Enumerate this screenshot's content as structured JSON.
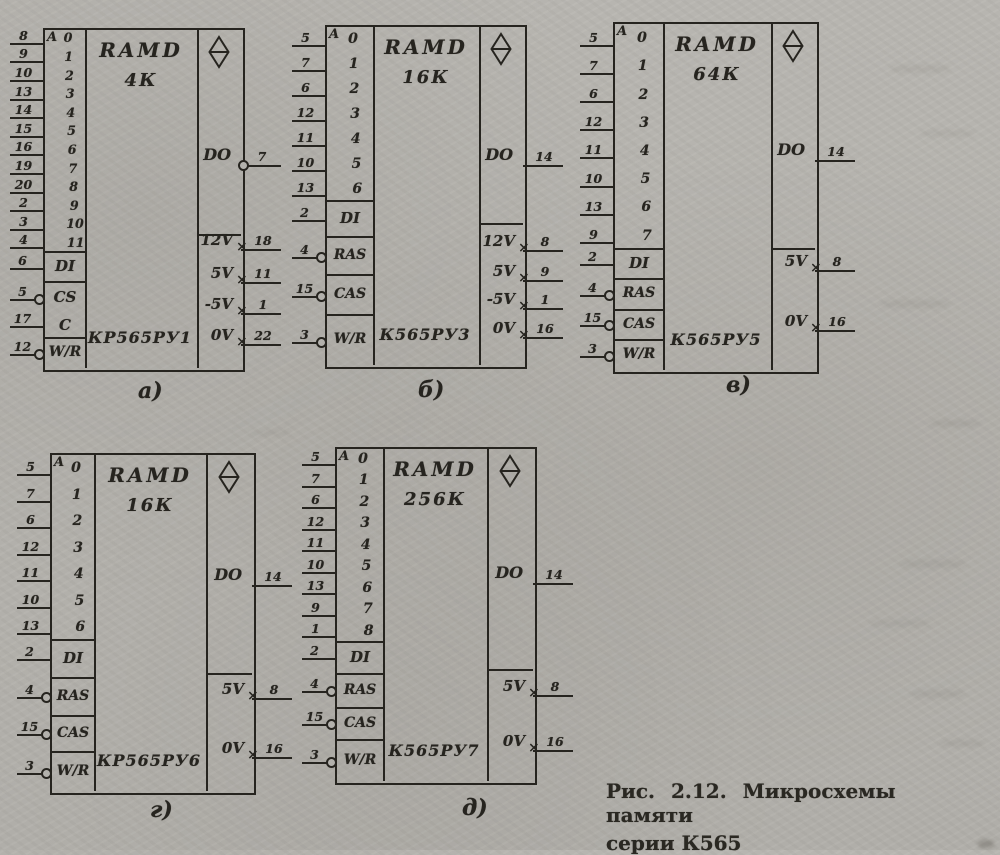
{
  "colors": {
    "ink": "#26241f",
    "paper": "#b3b1ac"
  },
  "icons": {
    "output_indicator": "tristate-diamond-icon",
    "inversion_marker": "inversion-circle-icon",
    "power_pin_marker": "×"
  },
  "figure": {
    "caption_line1": "Рис. 2.12. Микросхемы памяти",
    "caption_line2": "серии К565",
    "chips": [
      {
        "id": "a",
        "label": "а)",
        "title": "RAMD",
        "capacity": "4К",
        "name": "КР565РУ1",
        "addr_header": "A",
        "addr": [
          {
            "idx": "0",
            "pin": "8"
          },
          {
            "idx": "1",
            "pin": "9"
          },
          {
            "idx": "2",
            "pin": "10"
          },
          {
            "idx": "3",
            "pin": "13"
          },
          {
            "idx": "4",
            "pin": "14"
          },
          {
            "idx": "5",
            "pin": "15"
          },
          {
            "idx": "6",
            "pin": "16"
          },
          {
            "idx": "7",
            "pin": "19"
          },
          {
            "idx": "8",
            "pin": "20"
          },
          {
            "idx": "9",
            "pin": "2"
          },
          {
            "idx": "10",
            "pin": "3"
          },
          {
            "idx": "11",
            "pin": "4"
          }
        ],
        "controls": [
          {
            "label": "DI",
            "pin": "6",
            "inv": false
          },
          {
            "label": "CS",
            "pin": "5",
            "inv": true
          },
          {
            "label": "C",
            "pin": "17",
            "inv": false
          },
          {
            "label": "W/R",
            "pin": "12",
            "inv": true
          }
        ],
        "out": {
          "label": "DO",
          "pin": "7",
          "inv": true
        },
        "power": [
          {
            "label": "12V",
            "pin": "18"
          },
          {
            "label": "5V",
            "pin": "11"
          },
          {
            "label": "-5V",
            "pin": "1"
          },
          {
            "label": "0V",
            "pin": "22"
          }
        ]
      },
      {
        "id": "b",
        "label": "б)",
        "title": "RAMD",
        "capacity": "16К",
        "name": "К565РУ3",
        "addr_header": "A",
        "addr": [
          {
            "idx": "0",
            "pin": "5"
          },
          {
            "idx": "1",
            "pin": "7"
          },
          {
            "idx": "2",
            "pin": "6"
          },
          {
            "idx": "3",
            "pin": "12"
          },
          {
            "idx": "4",
            "pin": "11"
          },
          {
            "idx": "5",
            "pin": "10"
          },
          {
            "idx": "6",
            "pin": "13"
          }
        ],
        "controls": [
          {
            "label": "DI",
            "pin": "2",
            "inv": false
          },
          {
            "label": "RAS",
            "pin": "4",
            "inv": true
          },
          {
            "label": "CAS",
            "pin": "15",
            "inv": true
          },
          {
            "label": "W/R",
            "pin": "3",
            "inv": true
          }
        ],
        "out": {
          "label": "DO",
          "pin": "14",
          "inv": false
        },
        "power": [
          {
            "label": "12V",
            "pin": "8"
          },
          {
            "label": "5V",
            "pin": "9"
          },
          {
            "label": "-5V",
            "pin": "1"
          },
          {
            "label": "0V",
            "pin": "16"
          }
        ]
      },
      {
        "id": "c",
        "label": "в)",
        "title": "RAMD",
        "capacity": "64К",
        "name": "К565РУ5",
        "addr_header": "A",
        "addr": [
          {
            "idx": "0",
            "pin": "5"
          },
          {
            "idx": "1",
            "pin": "7"
          },
          {
            "idx": "2",
            "pin": "6"
          },
          {
            "idx": "3",
            "pin": "12"
          },
          {
            "idx": "4",
            "pin": "11"
          },
          {
            "idx": "5",
            "pin": "10"
          },
          {
            "idx": "6",
            "pin": "13"
          },
          {
            "idx": "7",
            "pin": "9"
          }
        ],
        "controls": [
          {
            "label": "DI",
            "pin": "2",
            "inv": false
          },
          {
            "label": "RAS",
            "pin": "4",
            "inv": true
          },
          {
            "label": "CAS",
            "pin": "15",
            "inv": true
          },
          {
            "label": "W/R",
            "pin": "3",
            "inv": true
          }
        ],
        "out": {
          "label": "DO",
          "pin": "14",
          "inv": false
        },
        "power": [
          {
            "label": "5V",
            "pin": "8"
          },
          {
            "label": "0V",
            "pin": "16"
          }
        ]
      },
      {
        "id": "d",
        "label": "г)",
        "title": "RAMD",
        "capacity": "16К",
        "name": "КР565РУ6",
        "addr_header": "A",
        "addr": [
          {
            "idx": "0",
            "pin": "5"
          },
          {
            "idx": "1",
            "pin": "7"
          },
          {
            "idx": "2",
            "pin": "6"
          },
          {
            "idx": "3",
            "pin": "12"
          },
          {
            "idx": "4",
            "pin": "11"
          },
          {
            "idx": "5",
            "pin": "10"
          },
          {
            "idx": "6",
            "pin": "13"
          }
        ],
        "controls": [
          {
            "label": "DI",
            "pin": "2",
            "inv": false
          },
          {
            "label": "RAS",
            "pin": "4",
            "inv": true
          },
          {
            "label": "CAS",
            "pin": "15",
            "inv": true
          },
          {
            "label": "W/R",
            "pin": "3",
            "inv": true
          }
        ],
        "out": {
          "label": "DO",
          "pin": "14",
          "inv": false
        },
        "power": [
          {
            "label": "5V",
            "pin": "8"
          },
          {
            "label": "0V",
            "pin": "16"
          }
        ]
      },
      {
        "id": "e",
        "label": "д)",
        "title": "RAMD",
        "capacity": "256К",
        "name": "К565РУ7",
        "addr_header": "A",
        "addr": [
          {
            "idx": "0",
            "pin": "5"
          },
          {
            "idx": "1",
            "pin": "7"
          },
          {
            "idx": "2",
            "pin": "6"
          },
          {
            "idx": "3",
            "pin": "12"
          },
          {
            "idx": "4",
            "pin": "11"
          },
          {
            "idx": "5",
            "pin": "10"
          },
          {
            "idx": "6",
            "pin": "13"
          },
          {
            "idx": "7",
            "pin": "9"
          },
          {
            "idx": "8",
            "pin": "1"
          }
        ],
        "controls": [
          {
            "label": "DI",
            "pin": "2",
            "inv": false
          },
          {
            "label": "RAS",
            "pin": "4",
            "inv": true
          },
          {
            "label": "CAS",
            "pin": "15",
            "inv": true
          },
          {
            "label": "W/R",
            "pin": "3",
            "inv": true
          }
        ],
        "out": {
          "label": "DO",
          "pin": "14",
          "inv": false
        },
        "power": [
          {
            "label": "5V",
            "pin": "8"
          },
          {
            "label": "0V",
            "pin": "16"
          }
        ]
      }
    ]
  }
}
